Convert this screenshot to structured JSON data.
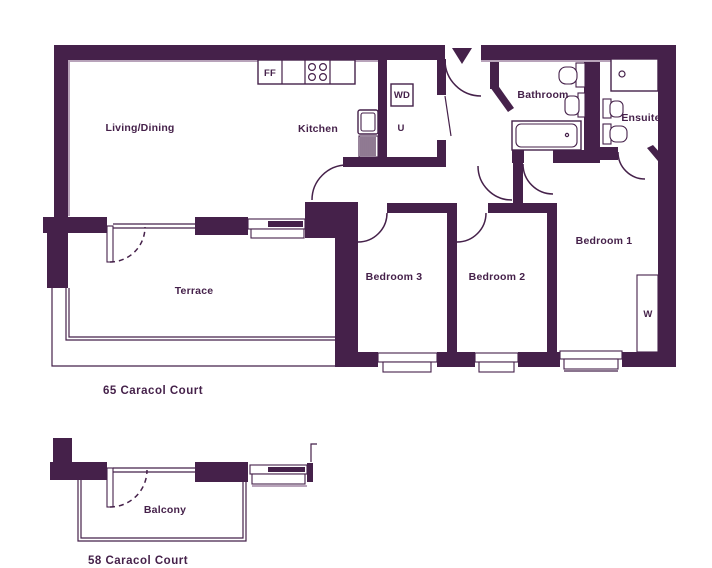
{
  "plan": {
    "title_upper": "65 Caracol Court",
    "title_lower": "58 Caracol Court",
    "colors": {
      "wall": "#45214a",
      "thin_line": "#b8a3ba",
      "background": "#ffffff"
    },
    "icons": {
      "entrance": "down-arrow-entrance-marker"
    },
    "labels": {
      "living": "Living/Dining",
      "kitchen": "Kitchen",
      "ff": "FF",
      "wd": "WD",
      "u": "U",
      "bathroom": "Bathroom",
      "ensuite": "Ensuite",
      "bedroom1": "Bedroom 1",
      "bedroom2": "Bedroom 2",
      "bedroom3": "Bedroom 3",
      "wardrobe": "W",
      "terrace": "Terrace",
      "balcony": "Balcony"
    }
  }
}
